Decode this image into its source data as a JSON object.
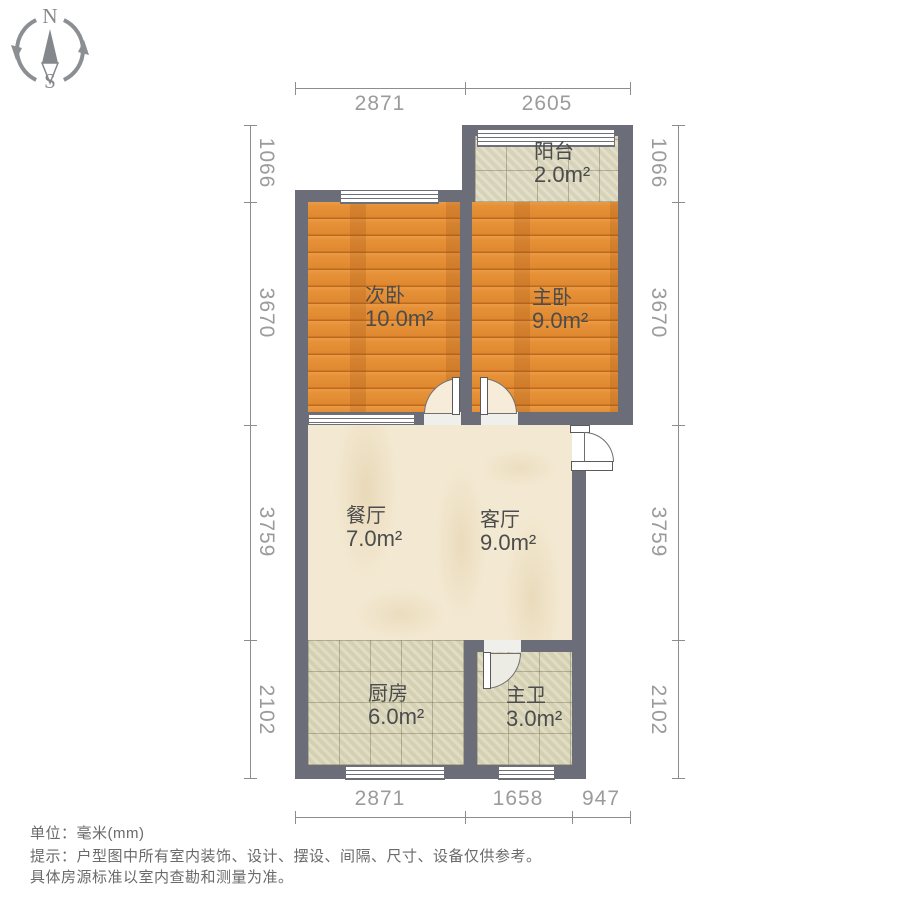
{
  "compass": {
    "north": "N",
    "south": "S"
  },
  "plan": {
    "rooms": [
      {
        "id": "balcony",
        "name": "阳台",
        "area": "2.0m²"
      },
      {
        "id": "second-bedroom",
        "name": "次卧",
        "area": "10.0m²"
      },
      {
        "id": "master-bedroom",
        "name": "主卧",
        "area": "9.0m²"
      },
      {
        "id": "dining-room",
        "name": "餐厅",
        "area": "7.0m²"
      },
      {
        "id": "living-room",
        "name": "客厅",
        "area": "9.0m²"
      },
      {
        "id": "kitchen",
        "name": "厨房",
        "area": "6.0m²"
      },
      {
        "id": "master-bath",
        "name": "主卫",
        "area": "3.0m²"
      }
    ]
  },
  "dimensions": {
    "top": [
      "2871",
      "2605"
    ],
    "bottom": [
      "2871",
      "1658",
      "947"
    ],
    "left": [
      "1066",
      "3670",
      "3759",
      "2102"
    ],
    "right": [
      "1066",
      "3670",
      "3759",
      "2102"
    ]
  },
  "footer": {
    "unit": "单位：毫米(mm)",
    "tip1": "提示：户型图中所有室内装饰、设计、摆设、间隔、尺寸、设备仅供参考。",
    "tip2": "具体房源标准以室内查勘和测量为准。"
  },
  "colors": {
    "wall": "#6b6e78",
    "wood_floor": "#e69138",
    "tile_floor": "#dbd7ba",
    "marble_floor": "#f3e9d2",
    "dimension_text": "#9b9b9b",
    "room_label_text": "#4c4c4c"
  }
}
